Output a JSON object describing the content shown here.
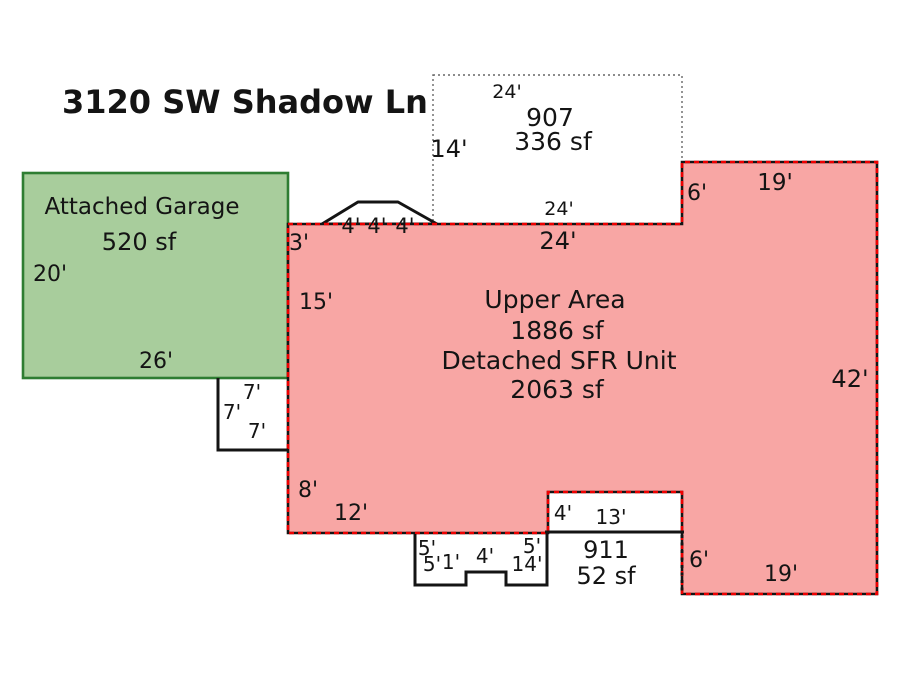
{
  "title": "3120 SW Shadow Ln",
  "colors": {
    "upper_fill": "#f8a6a4",
    "upper_border": "#ee0000",
    "garage_fill": "#a8cd9c",
    "garage_border": "#2e7d32",
    "outline_black": "#141414",
    "dotted_gray": "#666666"
  },
  "garage": {
    "label": "Attached Garage",
    "area": "520 sf",
    "dim_left": "20'",
    "dim_bottom": "26'"
  },
  "unit907": {
    "id": "907",
    "area": "336 sf",
    "dim_top": "24'",
    "dim_left": "14'",
    "dim_bottom": "24'"
  },
  "upper": {
    "title": "Upper Area",
    "area": "1886 sf",
    "subtitle": "Detached SFR Unit",
    "total_area": "2063 sf",
    "dim_top": "24'",
    "bay_dims": [
      "4'",
      "4'",
      "4'"
    ],
    "dim_left_step": "3'",
    "dim_left_upper": "15'",
    "dim_left_lower": "8'",
    "dim_bottom_left": "12'",
    "dim_step_top_right": "6'",
    "dim_top_right": "19'",
    "dim_right": "42'",
    "dim_bottom_right": "19'",
    "dim_step_bottom_right": "6'"
  },
  "notch_dims": [
    "7'",
    "7'",
    "7'"
  ],
  "porch_dims": [
    "5'",
    "5'",
    "1'",
    "4'",
    "5'",
    "14'"
  ],
  "unit911": {
    "id": "911",
    "area": "52 sf",
    "dim_height": "4'",
    "dim_width": "13'"
  }
}
